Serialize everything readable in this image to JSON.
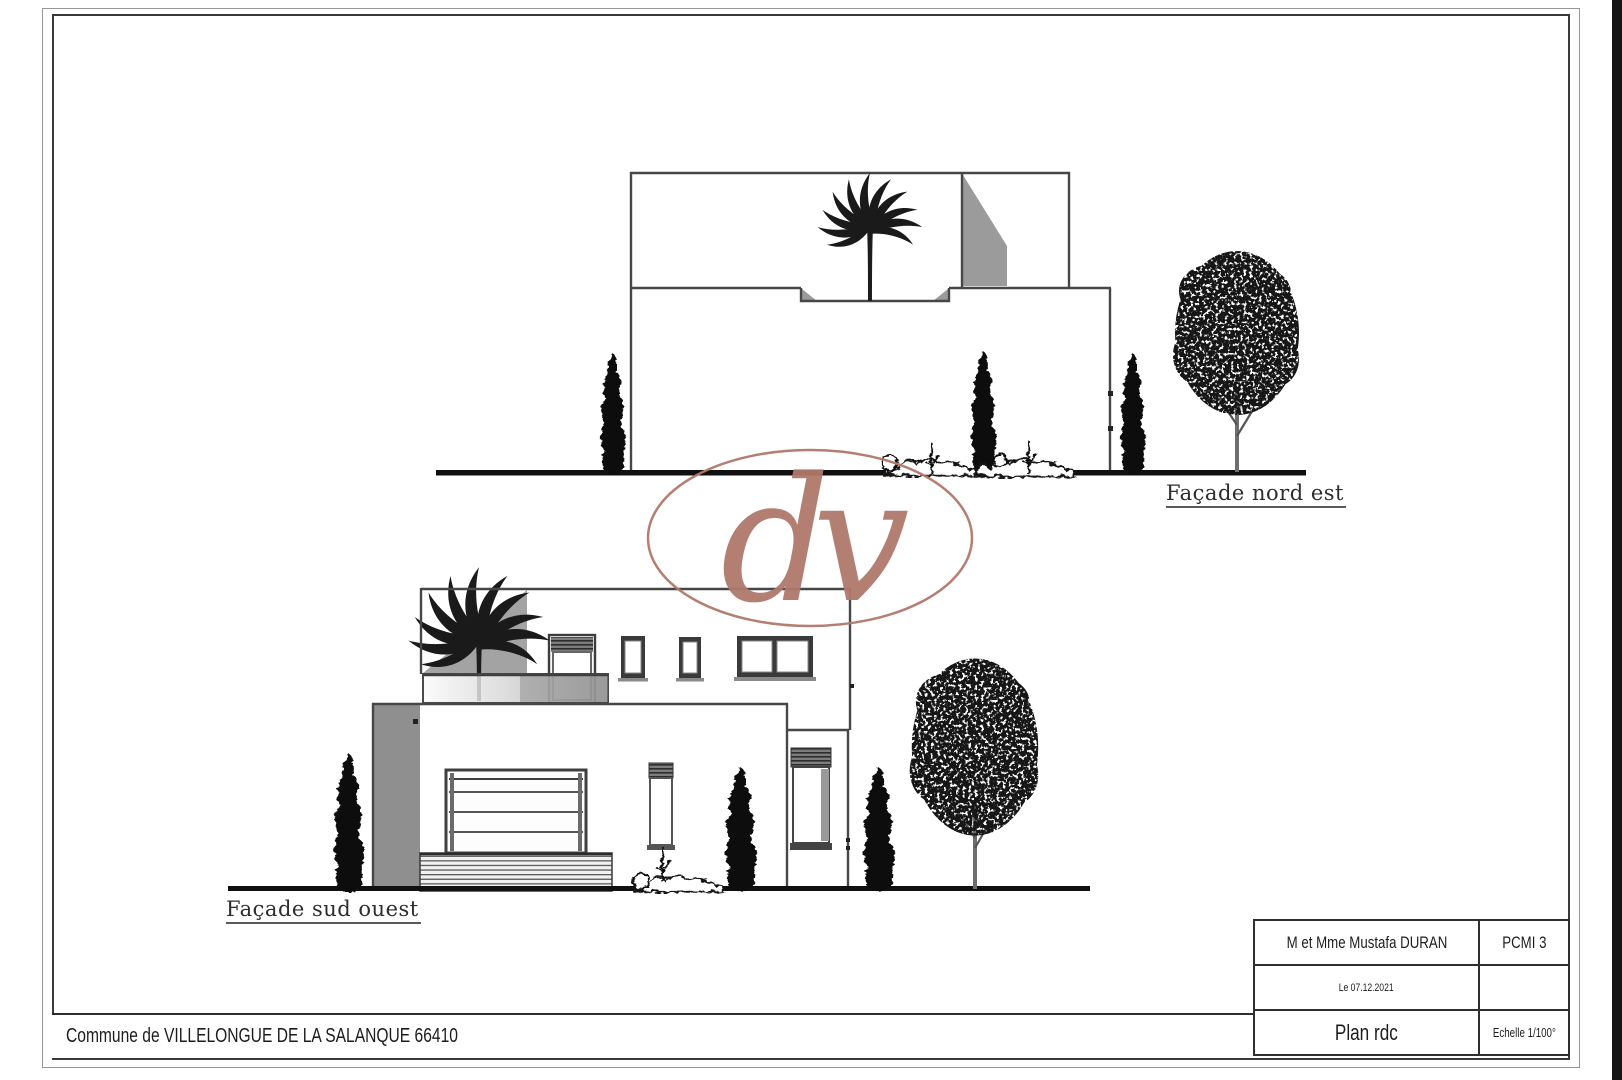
{
  "colors": {
    "accent": "#b1796c",
    "ink": "#2f2f2f"
  },
  "watermark": {
    "letters": "dv"
  },
  "elevations": [
    {
      "id": "nord-est",
      "label": "Façade nord est"
    },
    {
      "id": "sud-ouest",
      "label": "Façade sud ouest"
    }
  ],
  "title_block": {
    "rows": [
      {
        "left": "M et Mme Mustafa DURAN",
        "right": "PCMI 3"
      },
      {
        "left": "Le 07.12.2021",
        "right": ""
      },
      {
        "left": "Plan rdc",
        "right": "Echelle 1/100°"
      }
    ]
  },
  "footer": {
    "commune": "Commune de VILLELONGUE DE LA SALANQUE 66410"
  }
}
